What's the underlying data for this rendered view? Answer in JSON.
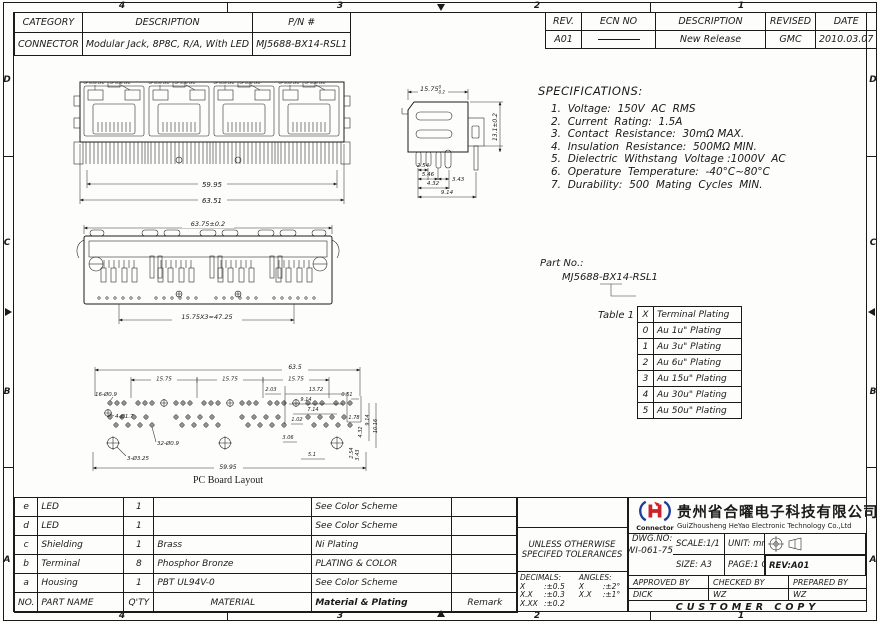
{
  "border": {
    "top": [
      "4",
      "3",
      "2",
      "1"
    ],
    "bottom": [
      "4",
      "3",
      "2",
      "1"
    ],
    "left": [
      "D",
      "C",
      "B",
      "A"
    ],
    "right": [
      "D",
      "C",
      "B",
      "A"
    ]
  },
  "header_table": {
    "headers": [
      "CATEGORY",
      "DESCRIPTION",
      "P/N #"
    ],
    "row": [
      "CONNECTOR",
      "Modular Jack, 8P8C, R/A, With LED",
      "MJ5688-BX14-RSL1"
    ]
  },
  "revision_table": {
    "headers": [
      "REV.",
      "ECN NO",
      "DESCRIPTION",
      "REVISED",
      "DATE"
    ],
    "row": {
      "rev": "A01",
      "description": "New Release",
      "revised": "GMC",
      "date": "2010.03.07"
    }
  },
  "specifications": {
    "title": "SPECIFICATIONS:",
    "items": [
      "1.  Voltage:  150V  AC  RMS",
      "2.  Current  Rating:  1.5A",
      "3.  Contact  Resistance:  30mΩ MAX.",
      "4.  Insulation  Resistance:  500MΩ MIN.",
      "5.  Dielectric  Withstang  Voltage :1000V  AC",
      "6.  Operature  Temperature:  -40°C~80°C",
      "7.  Durability:  500  Mating  Cycles  MIN."
    ]
  },
  "part_no": {
    "label": "Part No.:",
    "value": "MJ5688-BX14-RSL1"
  },
  "table1": {
    "caption": "Table 1",
    "header": [
      "X",
      "Terminal Plating"
    ],
    "rows": [
      [
        "0",
        "Au 1u\" Plating"
      ],
      [
        "1",
        "Au 3u\" Plating"
      ],
      [
        "2",
        "Au 6u\" Plating"
      ],
      [
        "3",
        "Au 15u\" Plating"
      ],
      [
        "4",
        "Au 30u\" Plating"
      ],
      [
        "5",
        "Au 50u\" Plating"
      ]
    ]
  },
  "drawings": {
    "front": {
      "led_label": "OPTION LED",
      "dim_inner": "59.95",
      "dim_outer": "63.51"
    },
    "side": {
      "dim_width": "15.75",
      "tol_hi": "0",
      "tol_lo": "-0.2",
      "dim_height": "13.1±0.2",
      "d1": "2.54",
      "d2": "5.46",
      "d3": "3.43",
      "d4": "4.32",
      "d5": "9.14"
    },
    "rear": {
      "dim_top": "63.75±0.2",
      "dim_pitch": "15.75X3=47.25"
    },
    "pcb": {
      "caption": "PC Board Layout",
      "total_top": "63.5",
      "pitch": "15.75",
      "total_bottom": "59.95",
      "d1": "2.03",
      "d2": "13.72",
      "d3": "9.14",
      "d4": "0.51",
      "d5": "7.14",
      "d6": "1.02",
      "d7": "1.78",
      "d8": "3.06",
      "d9": "5.1",
      "v1": "9.14",
      "v2": "10.16",
      "v3": "4.32",
      "v4": "2.54",
      "v5": "3.43",
      "holes16": "16-Ø0.9",
      "holes4": "4-Ø1.7",
      "holes32": "32-Ø0.9",
      "holes3": "3-Ø3.25"
    }
  },
  "bom": {
    "headers": [
      "NO.",
      "PART NAME",
      "Q'TY",
      "MATERIAL",
      "Material & Plating",
      "Remark"
    ],
    "rows": [
      [
        "e",
        "LED",
        "1",
        "",
        "See Color Scheme",
        ""
      ],
      [
        "d",
        "LED",
        "1",
        "",
        "See Color Scheme",
        ""
      ],
      [
        "c",
        "Shielding",
        "1",
        "Brass",
        "Ni Plating",
        ""
      ],
      [
        "b",
        "Terminal",
        "8",
        "Phosphor Bronze",
        "PLATING & COLOR",
        ""
      ],
      [
        "a",
        "Housing",
        "1",
        "PBT UL94V-0",
        "See Color Scheme",
        ""
      ]
    ]
  },
  "tolerances": {
    "line1": "UNLESS OTHERWISE",
    "line2": "SPECIFED TOLERANCES",
    "decimals_label": "DECIMALS:",
    "angles_label": "ANGLES:",
    "decimals": [
      {
        "k": "X",
        "v": ":±0.5"
      },
      {
        "k": "X.X",
        "v": ":±0.3"
      },
      {
        "k": "X.XX",
        "v": ":±0.2"
      }
    ],
    "angles": [
      {
        "k": "X",
        "v": ":±2°"
      },
      {
        "k": "X.X",
        "v": ":±1°"
      }
    ]
  },
  "title_block": {
    "logo_text": "Connector",
    "company_cn": "贵州省合曜电子科技有限公司",
    "company_en": "GuiZhousheng HeYao Electronic Technology Co.,Ltd",
    "scale": "SCALE:1/1",
    "unit": "UNIT: mm",
    "dwg_label": "DWG.NO:",
    "dwg_no": "WI-061-751",
    "size": "SIZE: A3",
    "page": "PAGE:1 OF 1",
    "rev": "REV:A01",
    "approved_label": "APPROVED BY",
    "checked_label": "CHECKED BY",
    "prepared_label": "PREPARED BY",
    "approved": "DICK",
    "checked": "WZ",
    "prepared": "WZ",
    "footer": "CUSTOMER COPY"
  }
}
